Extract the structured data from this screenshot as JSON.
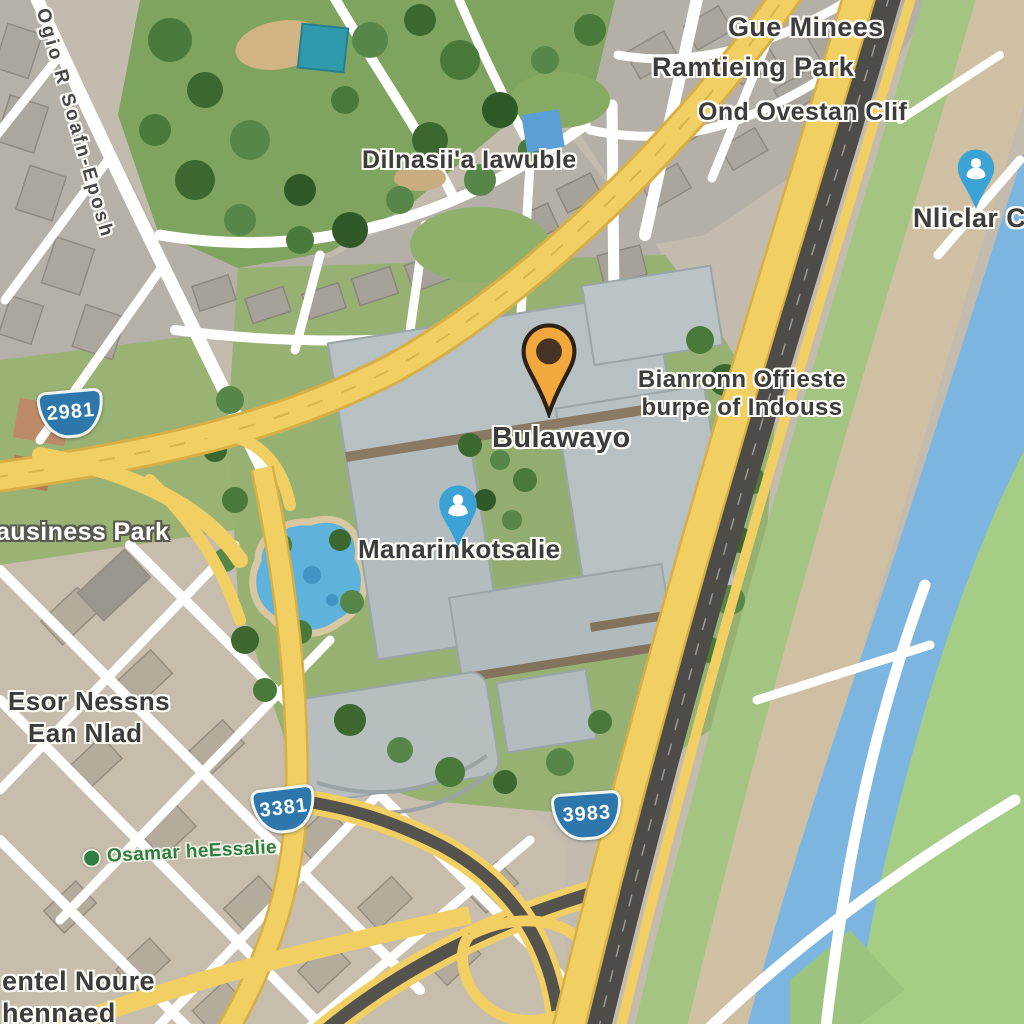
{
  "view": {
    "type": "satellite-map-view"
  },
  "labels": {
    "gue_minees": "Gue Minees",
    "ramtieing_park": "Ramtieing Park",
    "ond_ovestan": "Ond Ovestan Clif",
    "dilnasii": "Dilnasii'a Iawuble",
    "street_nw": "Ogio R Soafn-Eposh",
    "nliclar": "Nliclar Cfif",
    "bulawayo": "Bulawayo",
    "bianronn_line1": "Bianronn Offieste",
    "bianronn_line2": "burpe of Indouss",
    "manarinkotsalie": "Manarinkotsalie",
    "business_park": "ausiness Park",
    "esor_line1": "Esor Nessns",
    "esor_line2": "Ean Nlad",
    "osamar": "Osamar heEssalie",
    "entel_line1": "entel Noure",
    "entel_line2": "hennaed"
  },
  "route_shields": {
    "west": "2981",
    "southwest": "3381",
    "south": "3983"
  },
  "colors": {
    "pin-orange": "#F2A83C",
    "pin-orange-core": "#453323",
    "pin-blue": "#3BA2D6",
    "shield-blue": "#2D77AD",
    "water": "#7CB6E0",
    "road-yellow": "#F2CF63",
    "road-casing": "#D8AF45",
    "asphalt": "#4D4C48",
    "park-green": "#7FA45F",
    "label-green": "#2E7D43"
  }
}
